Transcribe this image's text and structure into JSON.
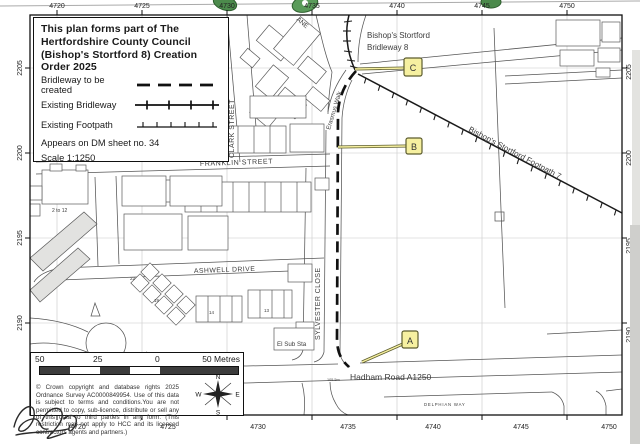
{
  "document": {
    "title_lines": [
      "This plan forms part of The",
      "Hertfordshire County Council",
      "(Bishop's Stortford 8) Creation",
      "Order 2025"
    ],
    "legend": {
      "items": [
        {
          "label": "Bridleway to be created",
          "symbol": "dashed-line"
        },
        {
          "label": "Existing Bridleway",
          "symbol": "crossed-line"
        },
        {
          "label": "Existing Footpath",
          "symbol": "ticked-line"
        }
      ],
      "sheet_note": "Appears on DM sheet  no. 34",
      "scale_note": "Scale 1:1250"
    },
    "scalebar": {
      "labels": [
        "50",
        "25",
        "0",
        "50 Metres"
      ]
    },
    "copyright": "© Crown copyright and database rights 2025 Ordnance Survey AC0000849954. Use of this data is subject to terms and conditions.You are not permitted to copy, sub-licence, distribute or sell any of this data to third parties in any form. (This restriction may not apply to HCC and its licenced contractors agents and partners.)",
    "compass": {
      "n": "N",
      "e": "E",
      "s": "S",
      "w": "W"
    }
  },
  "grid": {
    "eastings": [
      "4720",
      "4725",
      "4730",
      "4735",
      "4740",
      "4745",
      "4750"
    ],
    "northings": [
      "2205",
      "2200",
      "2195",
      "2190"
    ]
  },
  "map": {
    "markers": [
      {
        "letter": "A"
      },
      {
        "letter": "B"
      },
      {
        "letter": "C"
      }
    ],
    "labels": [
      {
        "text": "CLARK STREET"
      },
      {
        "text": "FRANKLIN STREET"
      },
      {
        "text": "ASHWELL DRIVE"
      },
      {
        "text": "SYLVESTER CLOSE"
      },
      {
        "text": "Erasmus Walk"
      },
      {
        "text": "ANE"
      },
      {
        "text": "Bishop's Stortford"
      },
      {
        "text": "Bridleway 8"
      },
      {
        "text": "Bishop's Stortford Footpath 7"
      },
      {
        "text": "El Sub Sta"
      },
      {
        "text": "Hadham Road  A1250"
      },
      {
        "text": "DELPHIAN WAY"
      },
      {
        "text": "105.5m"
      },
      {
        "text": "2 to 12"
      },
      {
        "text": "22"
      },
      {
        "text": "19"
      },
      {
        "text": "14"
      },
      {
        "text": "13"
      }
    ],
    "colors": {
      "marker_fill": "#f6f0a0",
      "marker_border": "#5c5c2e",
      "grid": "#c8c8c8",
      "ink": "#1a1a1a",
      "artifact_green": "#4c8a4c"
    }
  }
}
